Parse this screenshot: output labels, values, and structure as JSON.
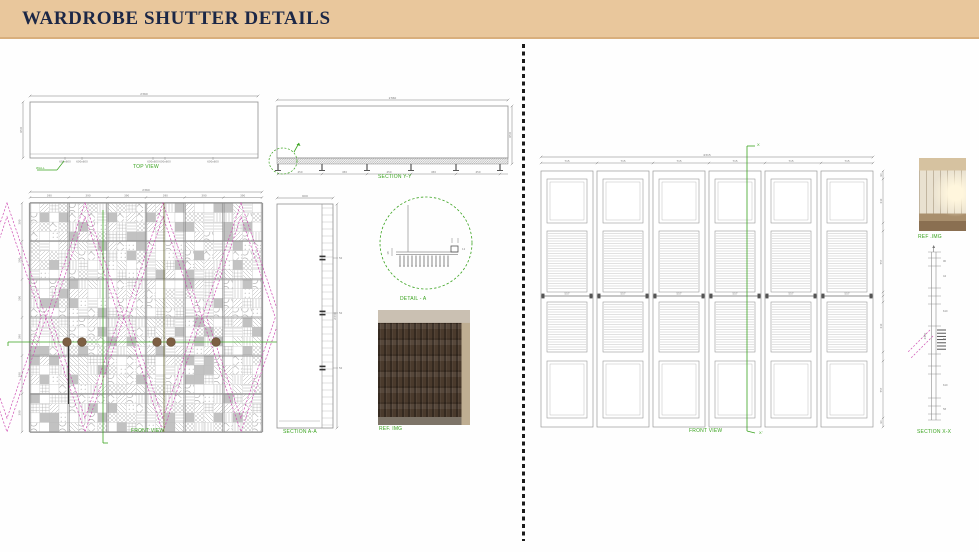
{
  "header": {
    "title": "WARDROBE SHUTTER DETAILS"
  },
  "colors": {
    "header_bg": "#e9c79c",
    "header_text": "#1c2746",
    "annotation_green": "#3aa31f",
    "line_grey": "#8f8f8f",
    "dim_grey": "#7a7a7a",
    "dark_line": "#444444",
    "magenta": "#cf4fb4",
    "knob_brown": "#7d5f43",
    "divider_black": "#1a1a1a",
    "solid_tile": "#c2c2c2"
  },
  "left": {
    "top_view": {
      "label": "TOP VIEW",
      "overall_dim": "2360",
      "depth_dim": "650",
      "wall_note": "WALL",
      "cell_dims": [
        "600x600",
        "600x600",
        "600x600",
        "600x600",
        "600x600"
      ]
    },
    "section_yy": {
      "label": "SECTION Y-Y",
      "overall_dim": "2360",
      "height_dim": "650",
      "support_dims": [
        "450",
        "450",
        "450",
        "450",
        "450"
      ]
    },
    "front_view": {
      "label": "FRONT VIEW",
      "overall_dim": "2360",
      "height_dim": "2330",
      "panel_dims": [
        "390",
        "390",
        "390",
        "390",
        "390",
        "390"
      ],
      "row_dims": [
        "390",
        "390",
        "390",
        "390",
        "390",
        "390"
      ]
    },
    "section_aa": {
      "label": "SECTION A-A",
      "width_dim": "600",
      "height_dim": "2330",
      "detail_dims": [
        "75",
        "50",
        "75"
      ]
    },
    "detail_a": {
      "label": "DETAIL - A",
      "dims": [
        "18",
        "12"
      ]
    },
    "ref_img": {
      "label": "REF. IMG"
    }
  },
  "right": {
    "front_view": {
      "label": "FRONT VIEW",
      "overall_dim": "4315",
      "panel_dims": [
        "715",
        "715",
        "715",
        "715",
        "715",
        "715"
      ],
      "mid_dims": [
        "557",
        "557",
        "557",
        "557",
        "557",
        "557"
      ],
      "height_dim": "2440",
      "frame_dims": [
        "90",
        "44",
        "610",
        "557",
        "610",
        "58",
        "90"
      ],
      "section_marker_top": "X",
      "section_marker_bottom": "X'"
    },
    "ref_img": {
      "label": "REF .IMG"
    },
    "section_xx": {
      "label": "SECTION X-X",
      "height_dim": "2440",
      "tick_dims": [
        "90",
        "44",
        "610",
        "55",
        "610",
        "58",
        "90"
      ]
    }
  }
}
